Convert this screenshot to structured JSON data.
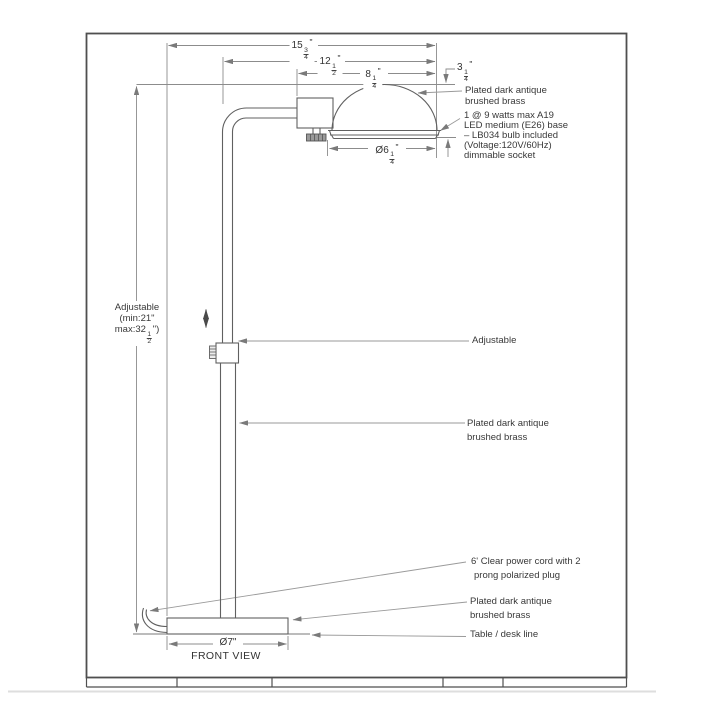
{
  "drawing": {
    "view_label": "FRONT VIEW",
    "dims": {
      "total": {
        "whole": "15",
        "num": "3",
        "den": "4",
        "unit": "\""
      },
      "reach": {
        "whole": "12",
        "num": "1",
        "den": "2",
        "unit": "\""
      },
      "head": {
        "whole": "8",
        "num": "1",
        "den": "4",
        "unit": "\""
      },
      "shade_height": {
        "whole": "3",
        "num": "1",
        "den": "4",
        "unit": "\""
      },
      "shade_dia": {
        "whole": "Ø6",
        "num": "1",
        "den": "4",
        "unit": "\""
      },
      "base_dia": "Ø7\"",
      "height": {
        "line1": "Adjustable",
        "line2": "(min:21\"",
        "line3_pre": "max:32",
        "line3_num": "1",
        "line3_den": "2",
        "line3_post": "\")"
      }
    },
    "notes": {
      "shade_finish_1": "Plated dark antique",
      "shade_finish_2": "brushed brass",
      "bulb_1": "1 @ 9 watts max A19",
      "bulb_2": "LED medium (E26) base",
      "bulb_3": "– LB034 bulb included",
      "bulb_4": "(Voltage:120V/60Hz)",
      "bulb_5": "dimmable socket",
      "adjustable": "Adjustable",
      "pole_finish_1": "Plated dark antique",
      "pole_finish_2": "brushed brass",
      "cord_1": "6' Clear power cord with 2",
      "cord_2": "prong polarized plug",
      "base_finish_1": "Plated dark antique",
      "base_finish_2": "brushed brass",
      "table_line": "Table / desk line"
    },
    "colors": {
      "object_line": "#606060",
      "dim_line": "#8c8c8c",
      "text": "#383838",
      "frame": "#4f4f4f"
    }
  }
}
